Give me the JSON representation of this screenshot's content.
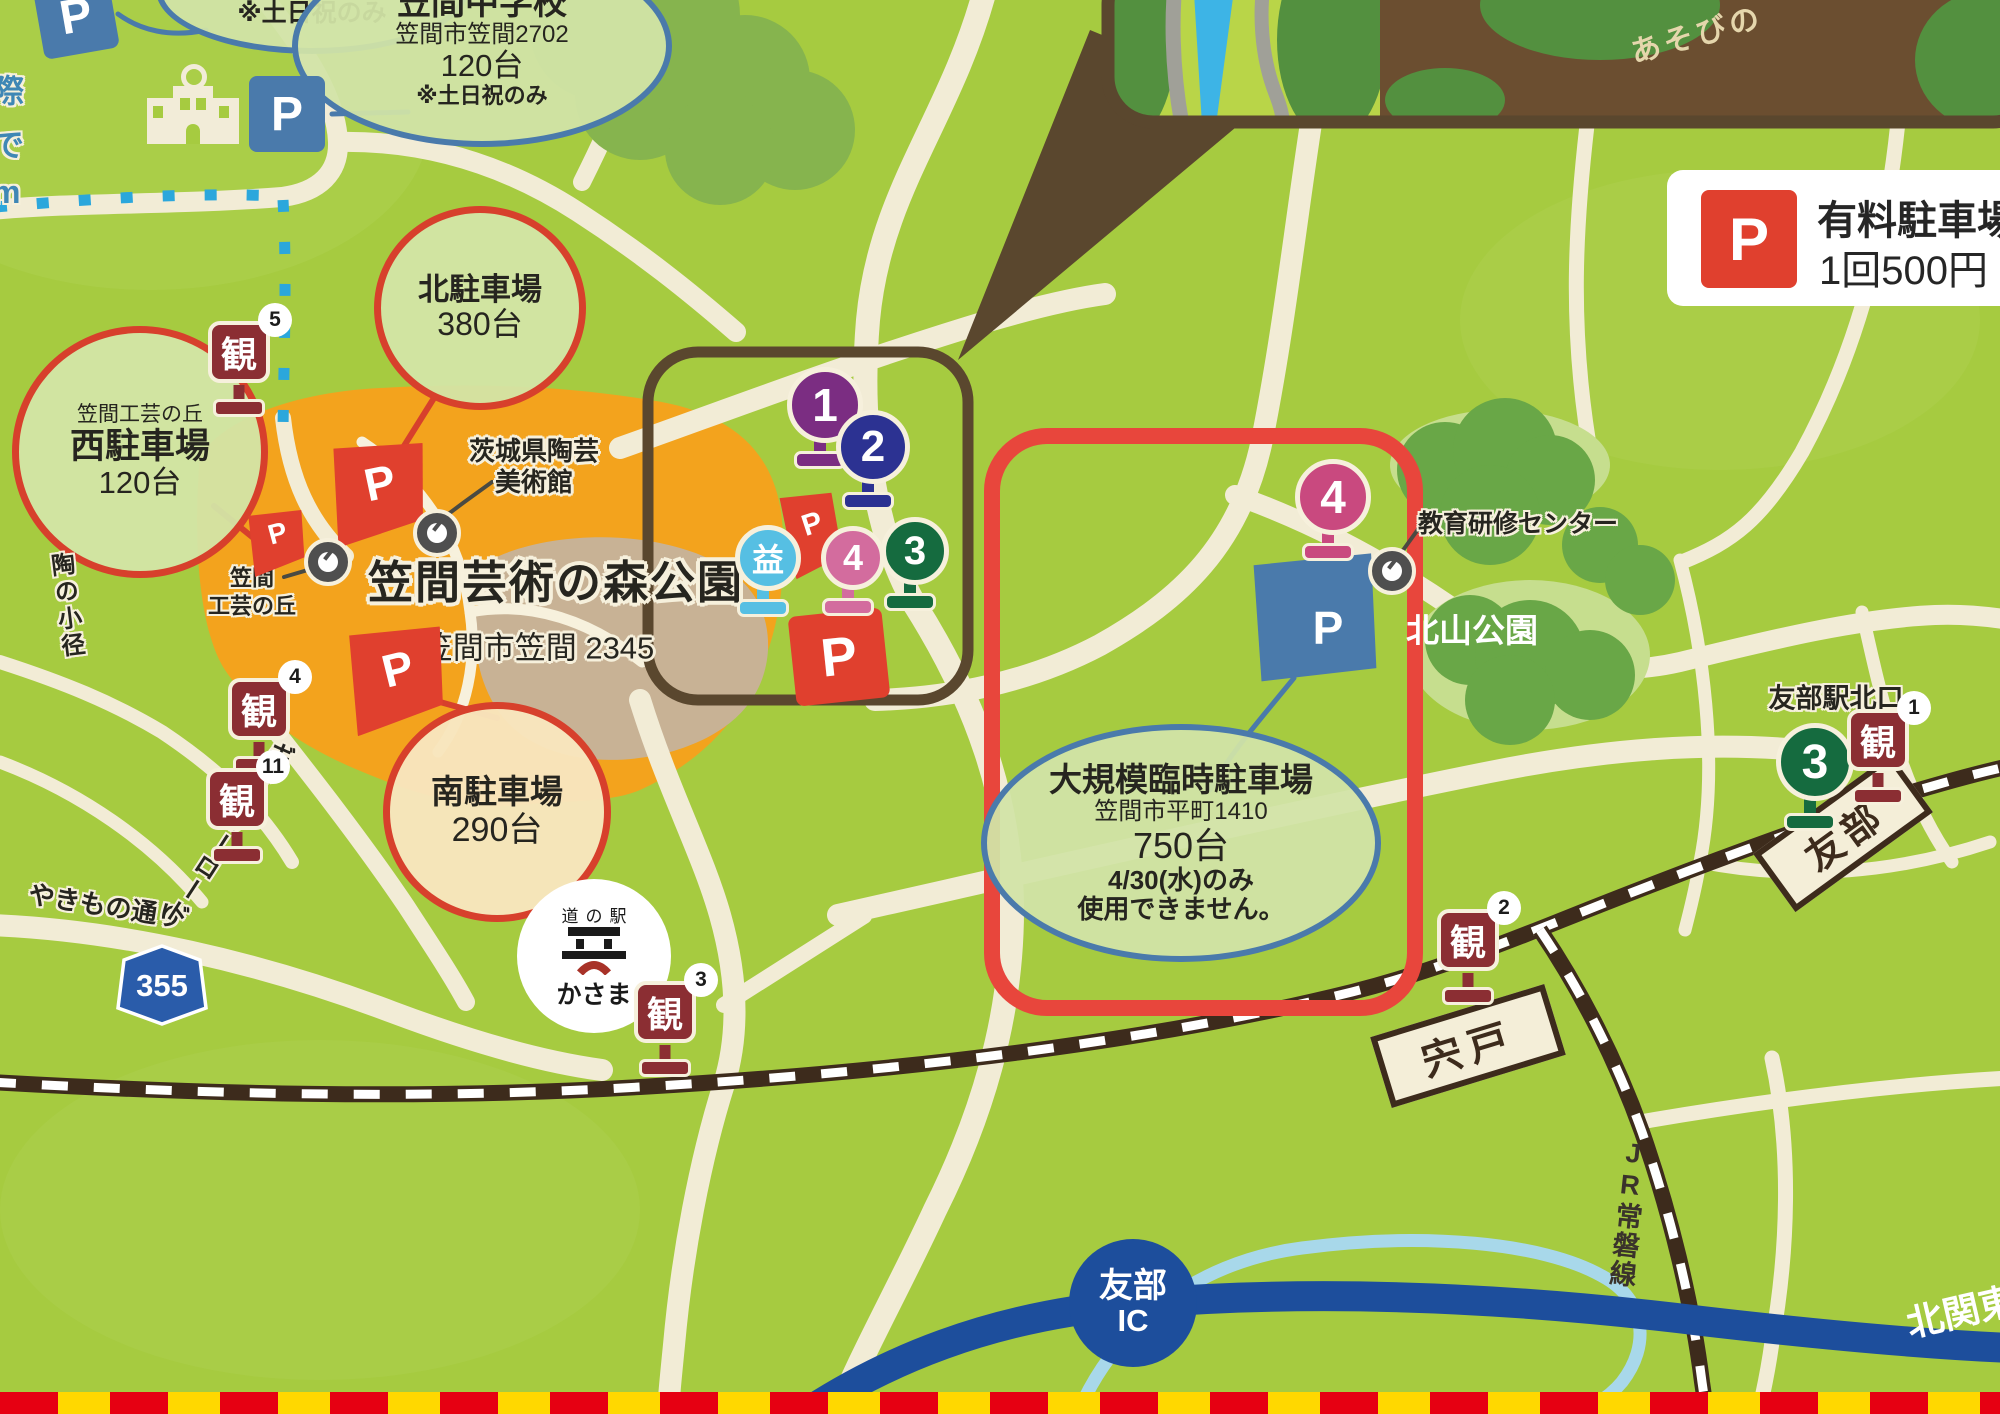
{
  "colors": {
    "background": "#a6cb40",
    "park_orange": "#f3a31d",
    "road": "#f2ecd6",
    "red_accent": "#d7402c",
    "blue_accent": "#4a7aab",
    "p_red": "#e0402e",
    "p_blue": "#4a7aab",
    "kan_red": "#8b2e33",
    "highway_blue": "#1d4e9c",
    "railway_brown": "#3d2b1c"
  },
  "p_label": "P",
  "legend": {
    "title": "有料駐車場",
    "price": "1回500円"
  },
  "inset": {
    "label": "あそびの"
  },
  "top_note": "※土日祝のみ",
  "junior_high": {
    "name": "笠間中学校",
    "address": "笠間市笠間2702",
    "capacity": "120台",
    "note": "※土日祝のみ"
  },
  "edge_chars": [
    "際",
    "で",
    "m"
  ],
  "lots": {
    "north": {
      "name": "北駐車場",
      "capacity": "380台"
    },
    "west": {
      "area": "笠間工芸の丘",
      "name": "西駐車場",
      "capacity": "120台"
    },
    "south": {
      "name": "南駐車場",
      "capacity": "290台"
    },
    "temp": {
      "name": "大規模臨時駐車場",
      "address": "笠間市平町1410",
      "capacity": "750台",
      "note1": "4/30(水)のみ",
      "note2": "使用できません。"
    }
  },
  "park": {
    "title": "笠間芸術の森公園",
    "address": "笠間市笠間 2345"
  },
  "museum": {
    "line1": "茨城県陶芸",
    "line2": "美術館"
  },
  "craft_hill": {
    "line1": "笠間",
    "line2": "工芸の丘"
  },
  "places": {
    "training_center": "教育研修センター",
    "kitayama_park": "北山公園",
    "tomobe_station_north": "友部駅北口",
    "michinoeki_prefix": "道の駅",
    "michinoeki_name": "かさま"
  },
  "stations": {
    "tomobe": "友部",
    "shishido": "宍戸",
    "jr_joban": "JR常磐線",
    "ic_name": "友部",
    "ic_suffix": "IC",
    "kitakanto": "北関東"
  },
  "road_labels": {
    "yakimono": "やきもの通り",
    "gallery": "ギャラリーロード",
    "tou_path": "陶の小径",
    "route_355": "355"
  },
  "kan": {
    "char": "観",
    "color": "#8b2e33",
    "markers": [
      {
        "num": "5"
      },
      {
        "num": "4"
      },
      {
        "num": "11"
      },
      {
        "num": "3"
      },
      {
        "num": "2"
      },
      {
        "num": "1"
      }
    ]
  },
  "pins": [
    {
      "label": "1",
      "color": "#7b2d82"
    },
    {
      "label": "2",
      "color": "#2c3292"
    },
    {
      "label": "益",
      "color": "#56bfe3"
    },
    {
      "label": "4",
      "color": "#d36c9e"
    },
    {
      "label": "3",
      "color": "#156b3f"
    },
    {
      "label": "4",
      "color": "#c9497f"
    },
    {
      "label": "3",
      "color": "#156b3f"
    }
  ]
}
